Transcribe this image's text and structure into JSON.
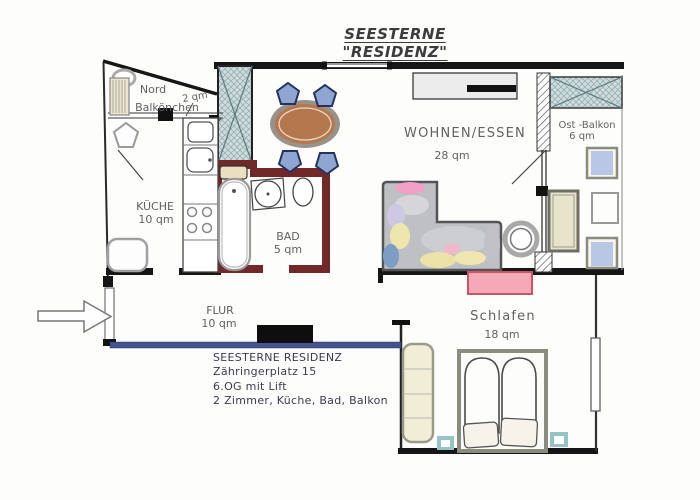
{
  "title": "SEESTERNE \"RESIDENZ\"",
  "plan": {
    "rooms": {
      "nord_balkon": {
        "line1": "Nord",
        "line2": "Balkönchen",
        "area": "2 qm"
      },
      "kueche": {
        "name": "KÜCHE",
        "area": "10 qm"
      },
      "bad": {
        "name": "BAD",
        "area": "5 qm"
      },
      "wohnen_essen": {
        "name": "WOHNEN/ESSEN",
        "area": "28 qm"
      },
      "ost_balkon": {
        "name": "Ost -Balkon",
        "area": "6 qm"
      },
      "flur": {
        "name": "FLUR",
        "area": "10 qm"
      },
      "schlafen": {
        "name": "Schlafen",
        "area": "18 qm"
      }
    },
    "colors": {
      "wall": "#161616",
      "bath_wall": "#702828",
      "flur_wall": "#44528e",
      "shaft_fill": "#cfdcdd",
      "dining_table": "#b5784e",
      "chair_blue": "#8fa6d2",
      "sofa_gray": "#bfc0c4",
      "bench_pink": "#f5a8b8",
      "wardrobe_cream": "#f2edd6",
      "nightstand_teal": "#96c4c4"
    }
  },
  "footer": {
    "lines": [
      "SEESTERNE RESIDENZ",
      "Zähringerplatz 15",
      "6.OG mit Lift",
      "2 Zimmer, Küche, Bad, Balkon"
    ]
  }
}
